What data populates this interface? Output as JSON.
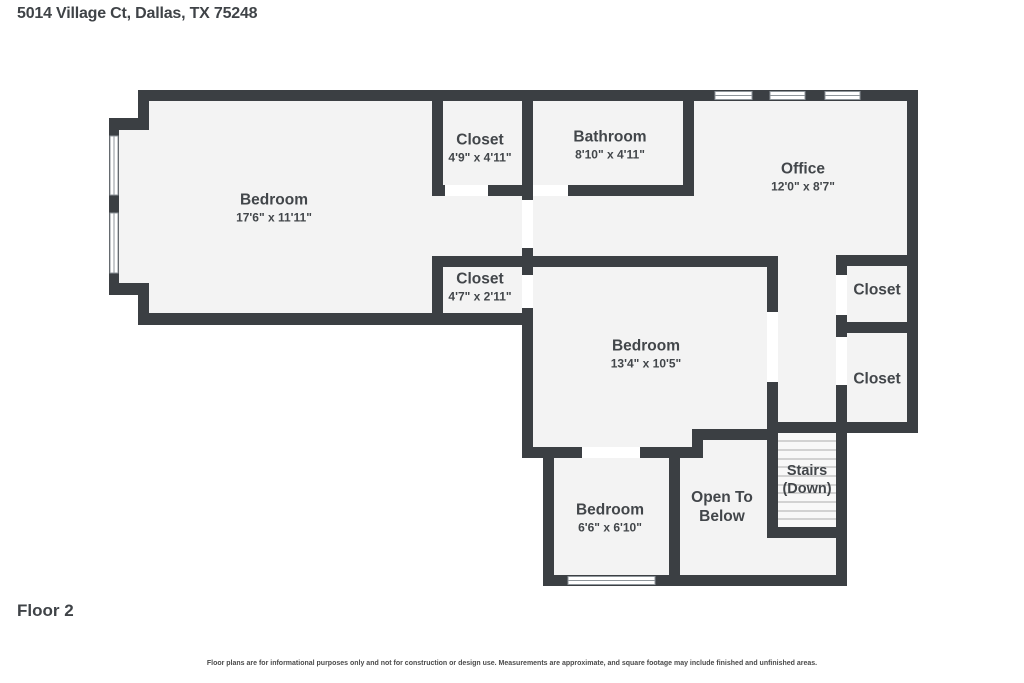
{
  "title": "5014 Village Ct, Dallas, TX 75248",
  "floor_label": "Floor 2",
  "disclaimer": "Floor plans are for informational purposes only and not for construction or design use. Measurements are approximate, and square footage may include finished and unfinished areas.",
  "colors": {
    "wall": "#3b3f43",
    "floor": "#f3f3f3",
    "door_opening": "#ffffff",
    "window": "#ffffff",
    "window_frame": "#8f969b",
    "stair_tread": "#c6c6c6",
    "text": "#42464a"
  },
  "rooms": [
    {
      "name": "Bedroom",
      "dims": "17'6\" x 11'11\""
    },
    {
      "name": "Closet",
      "dims": "4'9\" x 4'11\""
    },
    {
      "name": "Bathroom",
      "dims": "8'10\" x 4'11\""
    },
    {
      "name": "Office",
      "dims": "12'0\" x 8'7\""
    },
    {
      "name": "Closet",
      "dims": "4'7\" x 2'11\""
    },
    {
      "name": "Bedroom",
      "dims": "13'4\" x 10'5\""
    },
    {
      "name": "Closet"
    },
    {
      "name": "Closet"
    },
    {
      "name": "Bedroom",
      "dims": "6'6\" x 6'10\""
    }
  ],
  "areas": {
    "open_to_below": {
      "line1": "Open To",
      "line2": "Below"
    },
    "stairs": {
      "line1": "Stairs",
      "line2": "(Down)"
    }
  }
}
